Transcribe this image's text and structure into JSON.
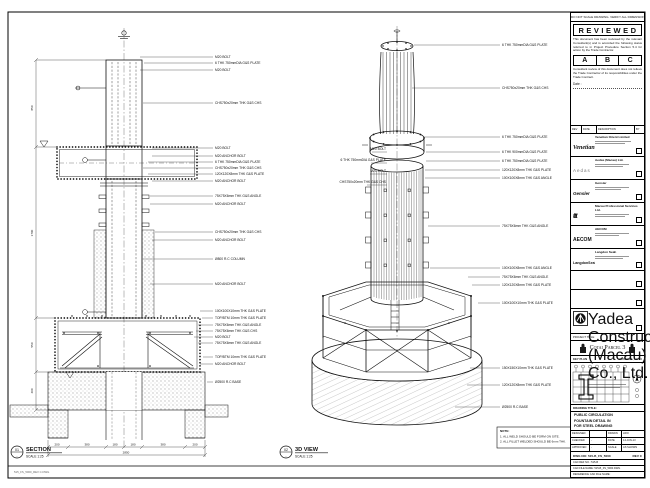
{
  "sheet": {
    "top_note": "DO NOT SCALE DRAWING. VERIFY ALL DIMENSIONS ON SITE.",
    "footer_note": "515_FS_5000_REV C.DWG"
  },
  "stamp": {
    "title": "REVIEWED",
    "para1": "This document has been reviewed by the relevant Consultant(s) and is accorded the following status referred to in Project Procedure Section 5.4 for action by the Trade Contractor.",
    "grades": [
      "A",
      "B",
      "C"
    ],
    "para2": "Consultant review of this document does not relieve the Trade Contractor of its responsibilities under the Trade Contract.",
    "date_label": "Date :"
  },
  "rev_header": {
    "cols": [
      "REV",
      "DATE",
      "DESCRIPTION",
      "BY"
    ]
  },
  "companies": [
    {
      "logo": "Venetian",
      "name": "Venetian Orient Limited"
    },
    {
      "logo": "Aedas",
      "name": "Aedas (Macau) Ltd."
    },
    {
      "logo": "Gensler",
      "name": "Gensler"
    },
    {
      "logo": "ttt",
      "name": "Macau Professional Services Ltd."
    },
    {
      "logo": "AECOM",
      "name": "AECOM"
    },
    {
      "logo": "LangdonSeah",
      "name": "Langdon Seah"
    }
  ],
  "contractor": {
    "name": "Yadea Construction (Macau) Co., Ltd."
  },
  "project": {
    "label": "PROJECT TITLE",
    "name": "Cotai Parcel 3"
  },
  "key_plan": {
    "label": "KEY PLAN",
    "plan_ref": "PARCEL 1, LOT 3"
  },
  "title_block": {
    "drawing_title_label": "DRAWING TITLE:",
    "drawing_title_lines": [
      "PUBLIC CIRCULATION",
      "FOUNTAIN DETAIL IN",
      "FOR STEEL DRAWING"
    ],
    "fields": [
      {
        "k": "DESIGNED",
        "v": "",
        "k2": "DRAWN",
        "v2": "LWO"
      },
      {
        "k": "CHECKED",
        "v": "-",
        "k2": "DATE",
        "v2": "14-JUN-13"
      },
      {
        "k": "APPROVED",
        "v": "-",
        "k2": "SCALE",
        "v2": "AS SHOWN"
      }
    ],
    "dwg_no_label": "DWG NO: 515-B_FS_5000",
    "rev_label": "REV C",
    "cad_ref": "CAD REF NO.: 515-B",
    "cad_file": "CAD FILE NAME: 515-B_FS_5000.DWG",
    "reference": "REFERENCE CAD FILE NAME:"
  },
  "section_view": {
    "bubble_no": "01",
    "bubble_den": "-",
    "title": "SECTION",
    "scale": "SCALE 1:25",
    "callouts": [
      "M20 BOLT",
      "6 THK 750mmDIA G&S PLATE",
      "M20 BOLT",
      "CHS750x20mm THK G&S CHS",
      "M20 BOLT",
      "M20 ANCHOR BOLT",
      "6 THK 750mmDIA G&S PLATE",
      "CHS750x20mm THK G&S CHS",
      "120X120X8mm THK G&S PLATE",
      "M20 ANCHOR BOLT",
      "75X75X6mm THK G&S ANGLE",
      "M20 ANCHOR BOLT",
      "CHS750x20mm THK G&S CHS",
      "M20 ANCHOR BOLT",
      "Ø800 R.C COLUMN",
      "M20 ANCHOR BOLT",
      "100X100X10mm THK G&S PLATE",
      "TOP/BTM 10mm THK G&S PLATE",
      "75X75X6mm THK G&S ANGLE",
      "75X75X6mm THK G&S CHS",
      "M20 BOLT",
      "75X75X6mm THK G&S ANGLE",
      "TOP/BTM 10mm THK G&S PLATE",
      "M20 ANCHOR BOLT",
      "Ø2500 R.C BASE"
    ],
    "dims_left": [
      "850",
      "1700",
      "550",
      "400"
    ],
    "dims_bottom": [
      "200",
      "380",
      "180",
      "180",
      "380",
      "200"
    ],
    "dims_total": "2850"
  },
  "view3d": {
    "bubble_no": "02",
    "bubble_den": "-",
    "title": "3D VIEW",
    "scale": "SCALE 1:25",
    "callouts_right": [
      "6 THK 750mmDIA G&S PLATE",
      "CHS750x20mm THK G&S CHS",
      "6 THK 750mmDIA G&S PLATE",
      "6 THK 900mmDIA G&S PLATE",
      "6 THK 750mmDIA G&S PLATE",
      "120X120X8mm THK G&S PLATE",
      "100X100X8mm THK G&S ANGLE",
      "75X75X6mm THK G&S ANGLE",
      "100X100X8mm THK G&S ANGLE",
      "75X75X6mm THK G&S ANGLE",
      "120X120X8mm THK G&S PLATE",
      "100X100X10mm THK G&S PLATE",
      "150X150X10mm THK G&S PLATE",
      "120X120X8mm THK G&S PLATE",
      "Ø2500 R.C BASE"
    ],
    "callouts_left": [
      "M20 BOLT",
      "6 THK 750mmDIA G&S PLATE",
      "M20 BOLT",
      "CHS750x20mm THK G&S CHS"
    ]
  },
  "notes": {
    "label": "NOTE:",
    "lines": [
      "1. ALL WELD SHOULD BE FORM ON SITE.",
      "2. ALL FILLET WELDED SHOULD BE 6mm THK."
    ]
  }
}
